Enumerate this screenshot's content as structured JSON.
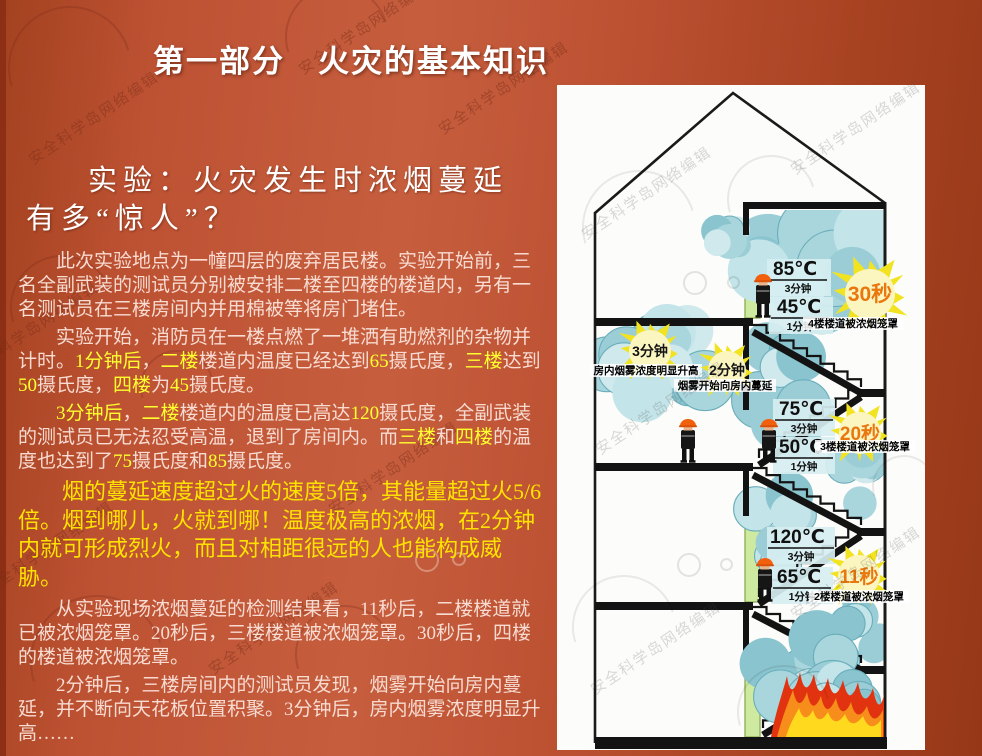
{
  "slide": {
    "title": "第一部分　火灾的基本知识",
    "subtitle": "实验：火灾发生时浓烟蔓延有多“惊人”？",
    "paragraphs": [
      {
        "emphasis": false,
        "segments": [
          {
            "text": "此次实验地点为一幢四层的废弃居民楼。实验开始前，三名全副武装的测试员分别被安排二楼至四楼的楼道内，另有一名测试员在三楼房间内并用棉被等将房门堵住。",
            "highlight": false
          }
        ]
      },
      {
        "emphasis": false,
        "segments": [
          {
            "text": "实验开始，消防员在一楼点燃了一堆洒有助燃剂的杂物并计时。",
            "highlight": false
          },
          {
            "text": "1分钟后",
            "highlight": true
          },
          {
            "text": "，",
            "highlight": false
          },
          {
            "text": "二楼",
            "highlight": true
          },
          {
            "text": "楼道内温度已经达到",
            "highlight": false
          },
          {
            "text": "65",
            "highlight": true
          },
          {
            "text": "摄氏度，",
            "highlight": false
          },
          {
            "text": "三楼",
            "highlight": true
          },
          {
            "text": "达到",
            "highlight": false
          },
          {
            "text": "50",
            "highlight": true
          },
          {
            "text": "摄氏度，",
            "highlight": false
          },
          {
            "text": "四楼",
            "highlight": true
          },
          {
            "text": "为",
            "highlight": false
          },
          {
            "text": "45",
            "highlight": true
          },
          {
            "text": "摄氏度。",
            "highlight": false
          }
        ]
      },
      {
        "emphasis": false,
        "segments": [
          {
            "text": "3分钟后",
            "highlight": true
          },
          {
            "text": "，",
            "highlight": false
          },
          {
            "text": "二楼",
            "highlight": true
          },
          {
            "text": "楼道内的温度已高达",
            "highlight": false
          },
          {
            "text": "120",
            "highlight": true
          },
          {
            "text": "摄氏度，全副武装的测试员已无法忍受高温，退到了房间内。而",
            "highlight": false
          },
          {
            "text": "三楼",
            "highlight": true
          },
          {
            "text": "和",
            "highlight": false
          },
          {
            "text": "四楼",
            "highlight": true
          },
          {
            "text": "的温度也达到了",
            "highlight": false
          },
          {
            "text": "75",
            "highlight": true
          },
          {
            "text": "摄氏度和",
            "highlight": false
          },
          {
            "text": "85",
            "highlight": true
          },
          {
            "text": "摄氏度。",
            "highlight": false
          }
        ]
      },
      {
        "emphasis": true,
        "segments": [
          {
            "text": "烟的蔓延速度超过火的速度5倍，其能量超过火5/6倍。烟到哪儿，火就到哪！温度极高的浓烟，在2分钟内就可形成烈火，而且对相距很远的人也能构成威胁。",
            "highlight": true
          }
        ]
      },
      {
        "emphasis": false,
        "segments": [
          {
            "text": "从实验现场浓烟蔓延的检测结果看，11秒后，二楼楼道就已被浓烟笼罩。20秒后，三楼楼道被浓烟笼罩。30秒后，四楼的楼道被浓烟笼罩。",
            "highlight": false
          }
        ]
      },
      {
        "emphasis": false,
        "segments": [
          {
            "text": "2分钟后，三楼房间内的测试员发现，烟雾开始向房内蔓延，并不断向天花板位置积聚。3分钟后，房内烟雾浓度明显升高……",
            "highlight": false
          }
        ]
      }
    ]
  },
  "watermark": {
    "text": "安全科学岛网络编辑"
  },
  "colors": {
    "background": "#bd5233",
    "highlight": "#ffff2e",
    "emphasis": "#ffe300",
    "body_text": "#f8dbd1",
    "smoke": "#a9d6dc",
    "burst": "#f2e320",
    "fire_red": "#e23311"
  },
  "diagram": {
    "floor4": {
      "temp_3min": "85℃",
      "time_3min": "3分钟",
      "temp_1min": "45℃",
      "time_1min": "1分钟",
      "burst": "30秒",
      "burst_caption": "4楼楼道被浓烟笼罩"
    },
    "floor3": {
      "burst_3min": "3分钟",
      "burst_3min_caption": "房内烟雾浓度明显升高",
      "burst_2min": "2分钟",
      "burst_2min_caption": "烟雾开始向房内蔓延",
      "temp_3min": "75℃",
      "time_3min": "3分钟",
      "temp_1min": "50℃",
      "time_1min": "1分钟",
      "burst": "20秒",
      "burst_caption": "3楼楼道被浓烟笼罩"
    },
    "floor2": {
      "temp_3min": "120℃",
      "time_3min": "3分钟",
      "temp_1min": "65℃",
      "time_1min": "1分钟",
      "burst": "11秒",
      "burst_caption": "2楼楼道被浓烟笼罩"
    }
  }
}
